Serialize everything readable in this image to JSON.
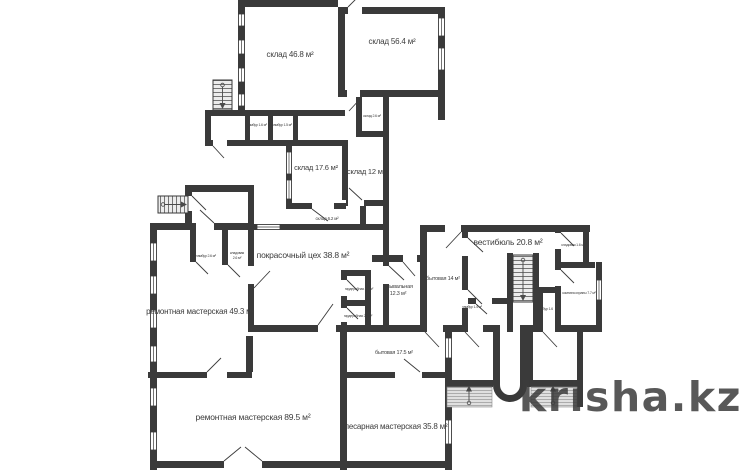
{
  "watermark": {
    "text": "krisha.kz",
    "color": "#c8c8c8"
  },
  "colors": {
    "wall": "#3a3a3a",
    "label": "#3c3c3c"
  },
  "labels": [
    {
      "id": "sklad-46-8",
      "text": "склад 46.8 м²"
    },
    {
      "id": "sklad-56-4",
      "text": "склад 56.4 м²"
    },
    {
      "id": "sklad-2-6",
      "text": "склад 2.6 м²"
    },
    {
      "id": "tambur-1-6-top",
      "text": "тамбур 1.6 м²"
    },
    {
      "id": "tambur-1-5-top",
      "text": "тамбур 1.5 м²"
    },
    {
      "id": "sklad-17-6",
      "text": "склад 17.6 м²"
    },
    {
      "id": "sklad-12",
      "text": "склад 12 м²"
    },
    {
      "id": "sklad-6-2",
      "text": "склад 6.2 м²"
    },
    {
      "id": "tambur-2-6",
      "text": "тамбур 2.6 м²"
    },
    {
      "id": "kladovaya-2-6-line1",
      "text": "кладовая"
    },
    {
      "id": "kladovaya-2-6-line2",
      "text": "2.6 м²"
    },
    {
      "id": "pokrasochny-tseh-38-8",
      "text": "покрасочный цех 38.8 м²"
    },
    {
      "id": "remontnaya-49-3",
      "text": "ремонтная мастерская 49.3 м²"
    },
    {
      "id": "vestibyul-20-8",
      "text": "вестибюль 20.8 м²"
    },
    {
      "id": "bytovaya-14",
      "text": "бытовая 14 м²"
    },
    {
      "id": "umyvalnaya-line1",
      "text": "умывальная"
    },
    {
      "id": "umyvalnaya-line2",
      "text": "12.3 м²"
    },
    {
      "id": "garderobnaya-2-8",
      "text": "гардеробная 2.8 м²"
    },
    {
      "id": "garderobnaya-2-4",
      "text": "гардеробная 2.4 м²"
    },
    {
      "id": "tambur-1-4",
      "text": "тамбур 1.4 м²"
    },
    {
      "id": "tambur-1-6-right",
      "text": "тамбур 1.6"
    },
    {
      "id": "kladovaya-1-6",
      "text": "кладовая 1.6 м²"
    },
    {
      "id": "komnata-ohrany-7-7",
      "text": "комната охраны 7.7 м²"
    },
    {
      "id": "bytovaya-17-5",
      "text": "бытовая 17.5 м²"
    },
    {
      "id": "remontnaya-89-5",
      "text": "ремонтная мастерская 89.5 м²"
    },
    {
      "id": "slesarnaya-35-8",
      "text": "слесарная мастерская 35.8 м²"
    }
  ]
}
